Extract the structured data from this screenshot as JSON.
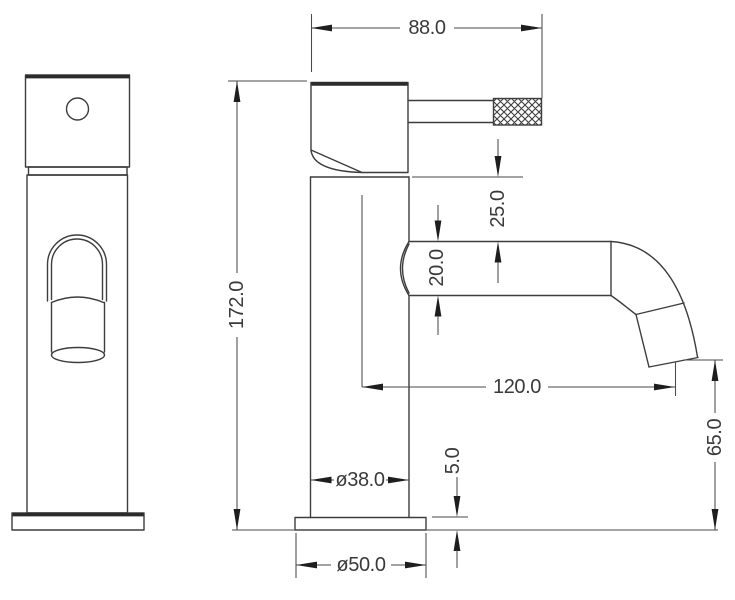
{
  "drawing": {
    "background": "#ffffff",
    "line_color": "#3d3d3d",
    "text_color": "#3a3a3a",
    "dimensions": {
      "handle_depth": {
        "label": "88.0"
      },
      "overall_height": {
        "label": "172.0"
      },
      "handle_to_spout_gap": {
        "label": "25.0"
      },
      "spout_tube_diameter": {
        "label": "20.0"
      },
      "spout_reach": {
        "label": "120.0"
      },
      "spout_outlet_height": {
        "label": "65.0"
      },
      "base_plate_thickness": {
        "label": "5.0"
      },
      "body_diameter": {
        "label": "ø38.0"
      },
      "base_diameter": {
        "label": "ø50.0"
      }
    }
  }
}
